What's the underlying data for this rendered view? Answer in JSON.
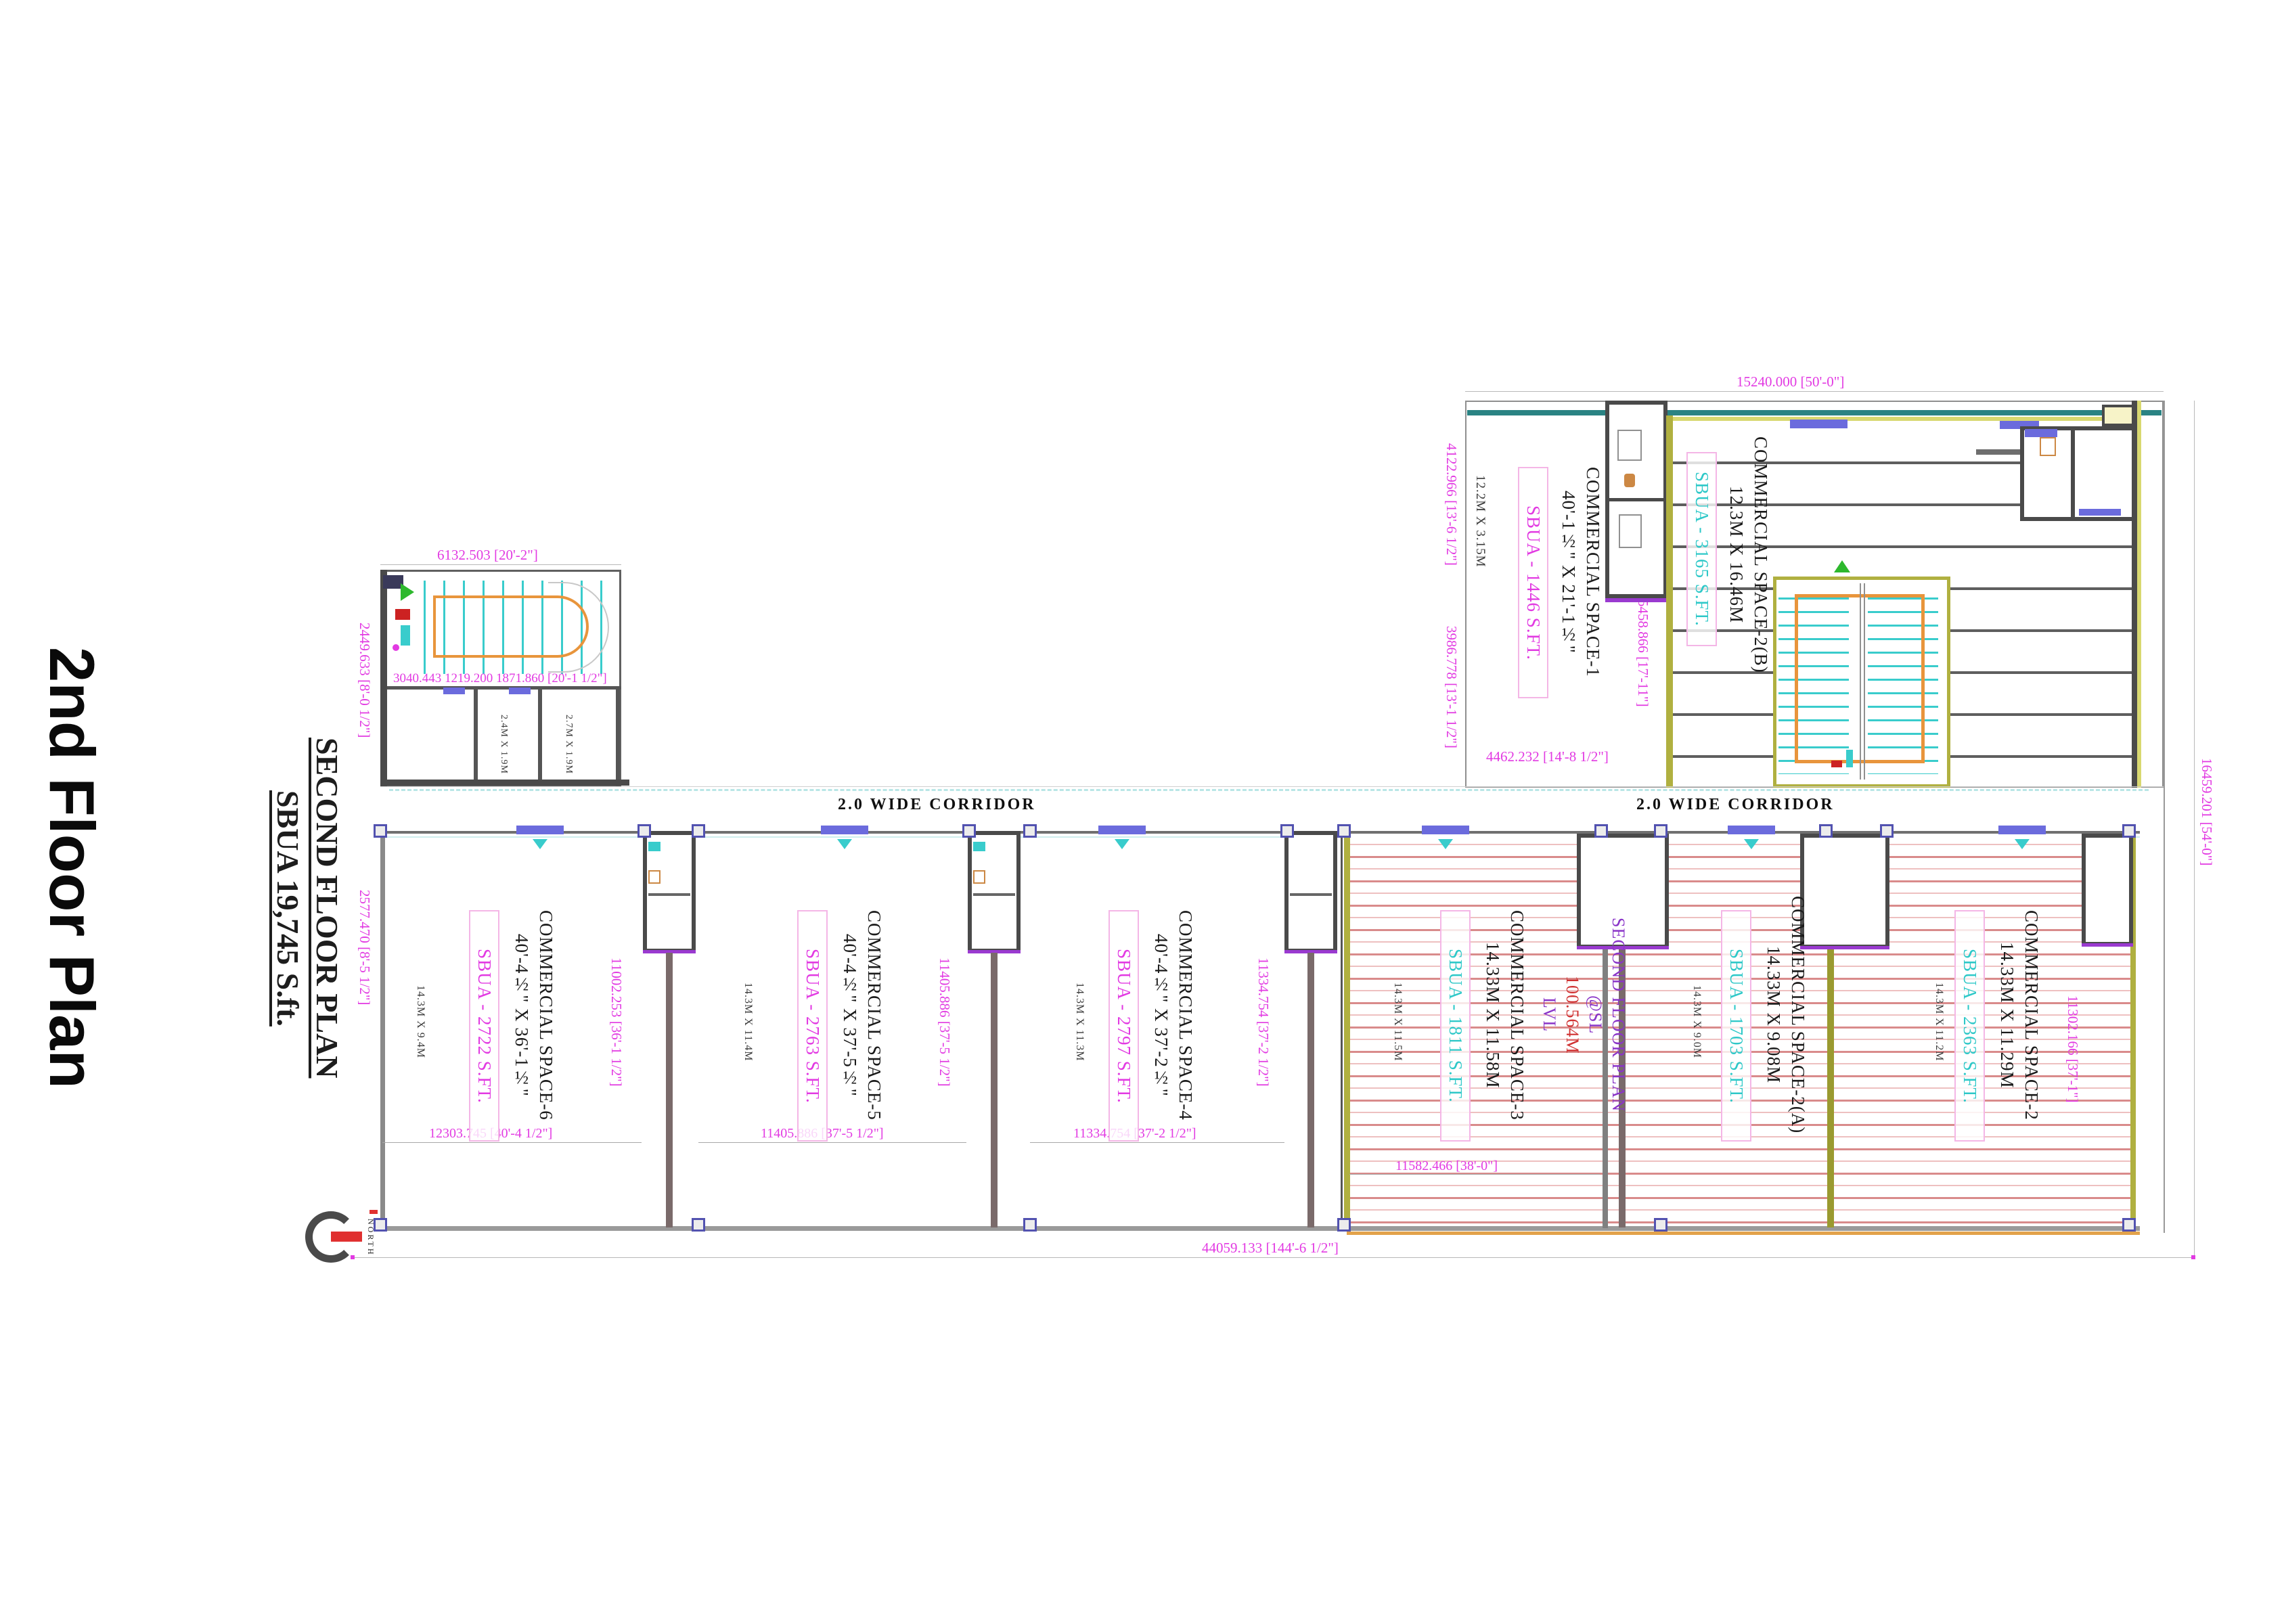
{
  "titles": {
    "main": "2nd Floor Plan",
    "sub1": "SECOND FLOOR PLAN",
    "sub2": "SBUA 19,745 S.ft."
  },
  "corridor_label": "2.0 WIDE CORRIDOR",
  "level_note": {
    "line1": "SECOND FLOOR PLAN",
    "at_prefix": "@SL ",
    "level": "100.564M",
    "suffix": " LVL"
  },
  "compass_label": "NORTH",
  "spaces": {
    "s1": {
      "name": "COMMERCIAL SPACE-1",
      "size": "40'-1½\" X 21'-1½\"",
      "sbua": "SBUA - 1446 S.FT."
    },
    "s2b": {
      "name": "COMMERCIAL SPACE-2(B)",
      "size": "12.3M X 16.46M",
      "sbua": "SBUA - 3165 S.FT."
    },
    "s2": {
      "name": "COMMERCIAL SPACE-2",
      "size": "14.33M X 11.29M",
      "sbua": "SBUA - 2363 S.FT."
    },
    "s2a": {
      "name": "COMMERCIAL SPACE-2(A)",
      "size": "14.33M X 9.08M",
      "sbua": "SBUA - 1703 S.FT."
    },
    "s3": {
      "name": "COMMERCIAL SPACE-3",
      "size": "14.33M X 11.58M",
      "sbua": "SBUA - 1811 S.FT."
    },
    "s4": {
      "name": "COMMERCIAL SPACE-4",
      "size": "40'-4½\" X 37'-2½\"",
      "sbua": "SBUA - 2797 S.FT."
    },
    "s5": {
      "name": "COMMERCIAL SPACE-5",
      "size": "40'-4½\" X 37'-5½\"",
      "sbua": "SBUA - 2763 S.FT."
    },
    "s6": {
      "name": "COMMERCIAL SPACE-6",
      "size": "40'-4½\" X 36'-1½\"",
      "sbua": "SBUA - 2722 S.FT."
    }
  },
  "small_sizes": {
    "upper_left": "12.2M X 3.15M",
    "s6": "14.3M X 9.4M",
    "s5": "14.3M X 11.4M",
    "s4": "14.3M X 11.3M",
    "s3": "14.3M X 11.5M",
    "s2a": "14.3M X 9.0M",
    "s2": "14.3M X 11.2M",
    "lift1": "2.4M X 1.9M",
    "lift2": "2.7M X 1.9M"
  },
  "dims": {
    "upper_top": "15240.000 [50'-0\"]",
    "upper_right": "16459.201 [54'-0\"]",
    "upper_left_a": "4122.966 [13'-6 1/2\"]",
    "upper_left_b": "3986.778 [13'-1 1/2\"]",
    "upper_inner": "5458.866 [17'-11\"]",
    "s1_bottom": "4462.232 [14'-8 1/2\"]",
    "stair_top": "6132.503 [20'-2\"]",
    "stair_mid": "3040.443  1219.200  1871.860 [20'-1 1/2\"]",
    "stair_left": "2449.633 [8'-0 1/2\"]",
    "band_left": "2577.470 [8'-5 1/2\"]",
    "s6_w": "12303.745 [40'-4 1/2\"]",
    "s5_w": "11405.886 [37'-5 1/2\"]",
    "s4_w": "11334.754 [37'-2 1/2\"]",
    "s3_w": "11582.466 [38'-0\"]",
    "wallA_v": "11002.253 [36'-1 1/2\"]",
    "wallB_v": "11405.886 [37'-5 1/2\"]",
    "wallC_v": "11334.754 [37'-2 1/2\"]",
    "s2_v": "11302.166 [37'-1\"]",
    "bottom_total": "44059.133 [144'-6 1/2\"]"
  },
  "colors": {
    "dimension_text": "#e23ae2",
    "sbua_magenta": "#e23ae2",
    "sbua_cyan": "#2ec8c8",
    "hatch_red": "#d98b8b",
    "wall_olive": "#b0b040",
    "wall_dark": "#4a4a4a",
    "stair_tread_cyan": "#39cccc",
    "rail_orange": "#e8953c",
    "door_blue": "#6b6bdd",
    "teal_band": "#2a8383",
    "note_purple": "#8a35c8",
    "level_red": "#d03232",
    "north_red": "#e03030"
  }
}
